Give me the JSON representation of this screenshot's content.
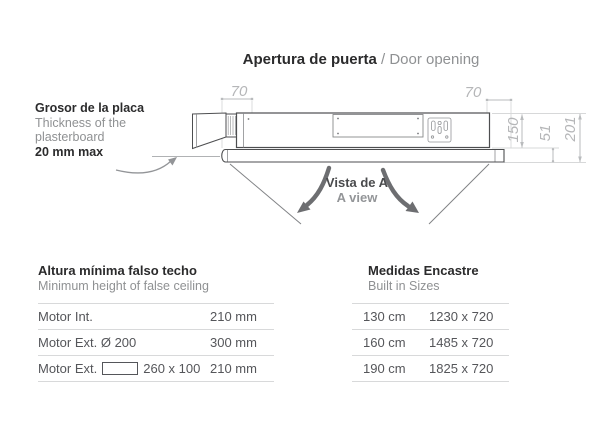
{
  "title": {
    "es": "Apertura de puerta",
    "en": " / Door opening"
  },
  "annotation": {
    "line1": "Grosor de la placa",
    "line2": "Thickness of the",
    "line3": "plasterboard",
    "line4": "20 mm max"
  },
  "diagram": {
    "dims": {
      "top_left": "70",
      "top_right": "70",
      "body_height": "150",
      "gap_height": "51",
      "total_height": "201"
    },
    "view_label_es": "Vista de A",
    "view_label_en": "A view"
  },
  "left_table": {
    "title_es": "Altura mínima falso techo",
    "title_en": "Minimum height of false ceiling",
    "rows": [
      {
        "label": "Motor Int.",
        "value": "210 mm"
      },
      {
        "label": "Motor Ext. Ø 200",
        "value": "300 mm"
      },
      {
        "label_prefix": "Motor Ext.",
        "symbol": "rect-outline",
        "label_suffix": "260 x 100",
        "value": "210 mm"
      }
    ]
  },
  "right_table": {
    "title_es": "Medidas Encastre",
    "title_en": "Built in Sizes",
    "rows": [
      {
        "label": "130 cm",
        "value": "1230 x 720"
      },
      {
        "label": "160 cm",
        "value": "1485 x 720"
      },
      {
        "label": "190 cm",
        "value": "1825 x 720"
      }
    ]
  },
  "colors": {
    "ink": "#2b2b2c",
    "gray_text": "#8f9193",
    "row_text": "#55565a",
    "divider": "#d8d9da",
    "drawing_stroke": "#4d4e50",
    "dimension": "#b5b6b8",
    "arrow": "#6d6e71"
  }
}
